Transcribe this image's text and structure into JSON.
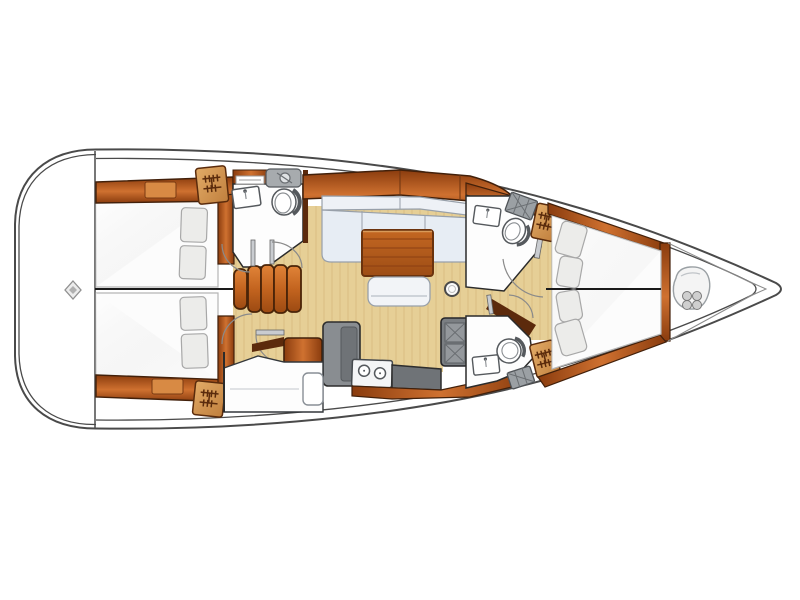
{
  "figure": {
    "type": "floor-plan",
    "subject": "sailing-yacht-interior-layout",
    "orientation": "bow-right",
    "visible_text": []
  },
  "palette": {
    "bg": "#ffffff",
    "hull-line": "#4a4a4a",
    "floor": "#e6cf96",
    "floor-grain": "#d9be81",
    "wood-hi": "#cf7130",
    "wood-lo": "#8a3c0e",
    "wood-edge": "#42200a",
    "wood-dark": "#5c2a0c",
    "tan-hi": "#e2ab67",
    "tan-lo": "#c07f3d",
    "mattress": "#fcfcfc",
    "mattress-edge": "#b5b5b5",
    "pillow": "#ececea",
    "pillow-edge": "#a8a8a8",
    "settee": "#e7edf4",
    "settee-back": "#eef1f6",
    "settee-edge": "#98a0aa",
    "table-hi": "#c46722",
    "table-lo": "#9d4d15",
    "table-edge": "#6b330d",
    "counter": "#898d91",
    "counter-dark": "#6f7377",
    "stove": "#7b7f83",
    "fixture-line": "#55595d",
    "room-white": "#fdfdfd",
    "arc-line": "#8a8a8a",
    "line-dark": "#1a1a1a"
  },
  "rooms": [
    {
      "name": "aft-cabin-port",
      "fixtures": [
        "double-berth",
        "two-pillows",
        "hull-side-cabinetry"
      ]
    },
    {
      "name": "aft-cabin-starboard",
      "fixtures": [
        "double-berth",
        "two-pillows",
        "hull-side-cabinetry",
        "hanging-locker"
      ]
    },
    {
      "name": "head-aft-port",
      "fixtures": [
        "toilet",
        "sink",
        "vanity-basin",
        "shelf",
        "hanging-locker"
      ]
    },
    {
      "name": "saloon",
      "fixtures": [
        "l-shaped-settee",
        "folding-table",
        "bench-seat",
        "compression-post"
      ]
    },
    {
      "name": "galley",
      "fixtures": [
        "counter",
        "twin-round-sinks",
        "two-burner-stove",
        "worktop"
      ]
    },
    {
      "name": "nav-station",
      "fixtures": [
        "chart-desk",
        "seat"
      ]
    },
    {
      "name": "head-forward-port",
      "fixtures": [
        "toilet",
        "sink",
        "shower-grate",
        "hanging-locker"
      ]
    },
    {
      "name": "head-forward-starboard",
      "fixtures": [
        "toilet",
        "sink",
        "shower-grate",
        "hanging-locker"
      ]
    },
    {
      "name": "owner-cabin-forward",
      "fixtures": [
        "v-berth-split-double",
        "four-pillows",
        "wood-surround"
      ]
    },
    {
      "name": "bow-locker",
      "fixtures": [
        "anchor-windlass"
      ]
    }
  ],
  "icons": [
    "hanger-icon",
    "stern-diamond-icon",
    "anchor-windlass-icon",
    "toilet-icon",
    "sink-faucet-icon",
    "shower-grate-icon",
    "stove-burner-icon",
    "compression-post-icon",
    "companionway-steps-icon"
  ]
}
